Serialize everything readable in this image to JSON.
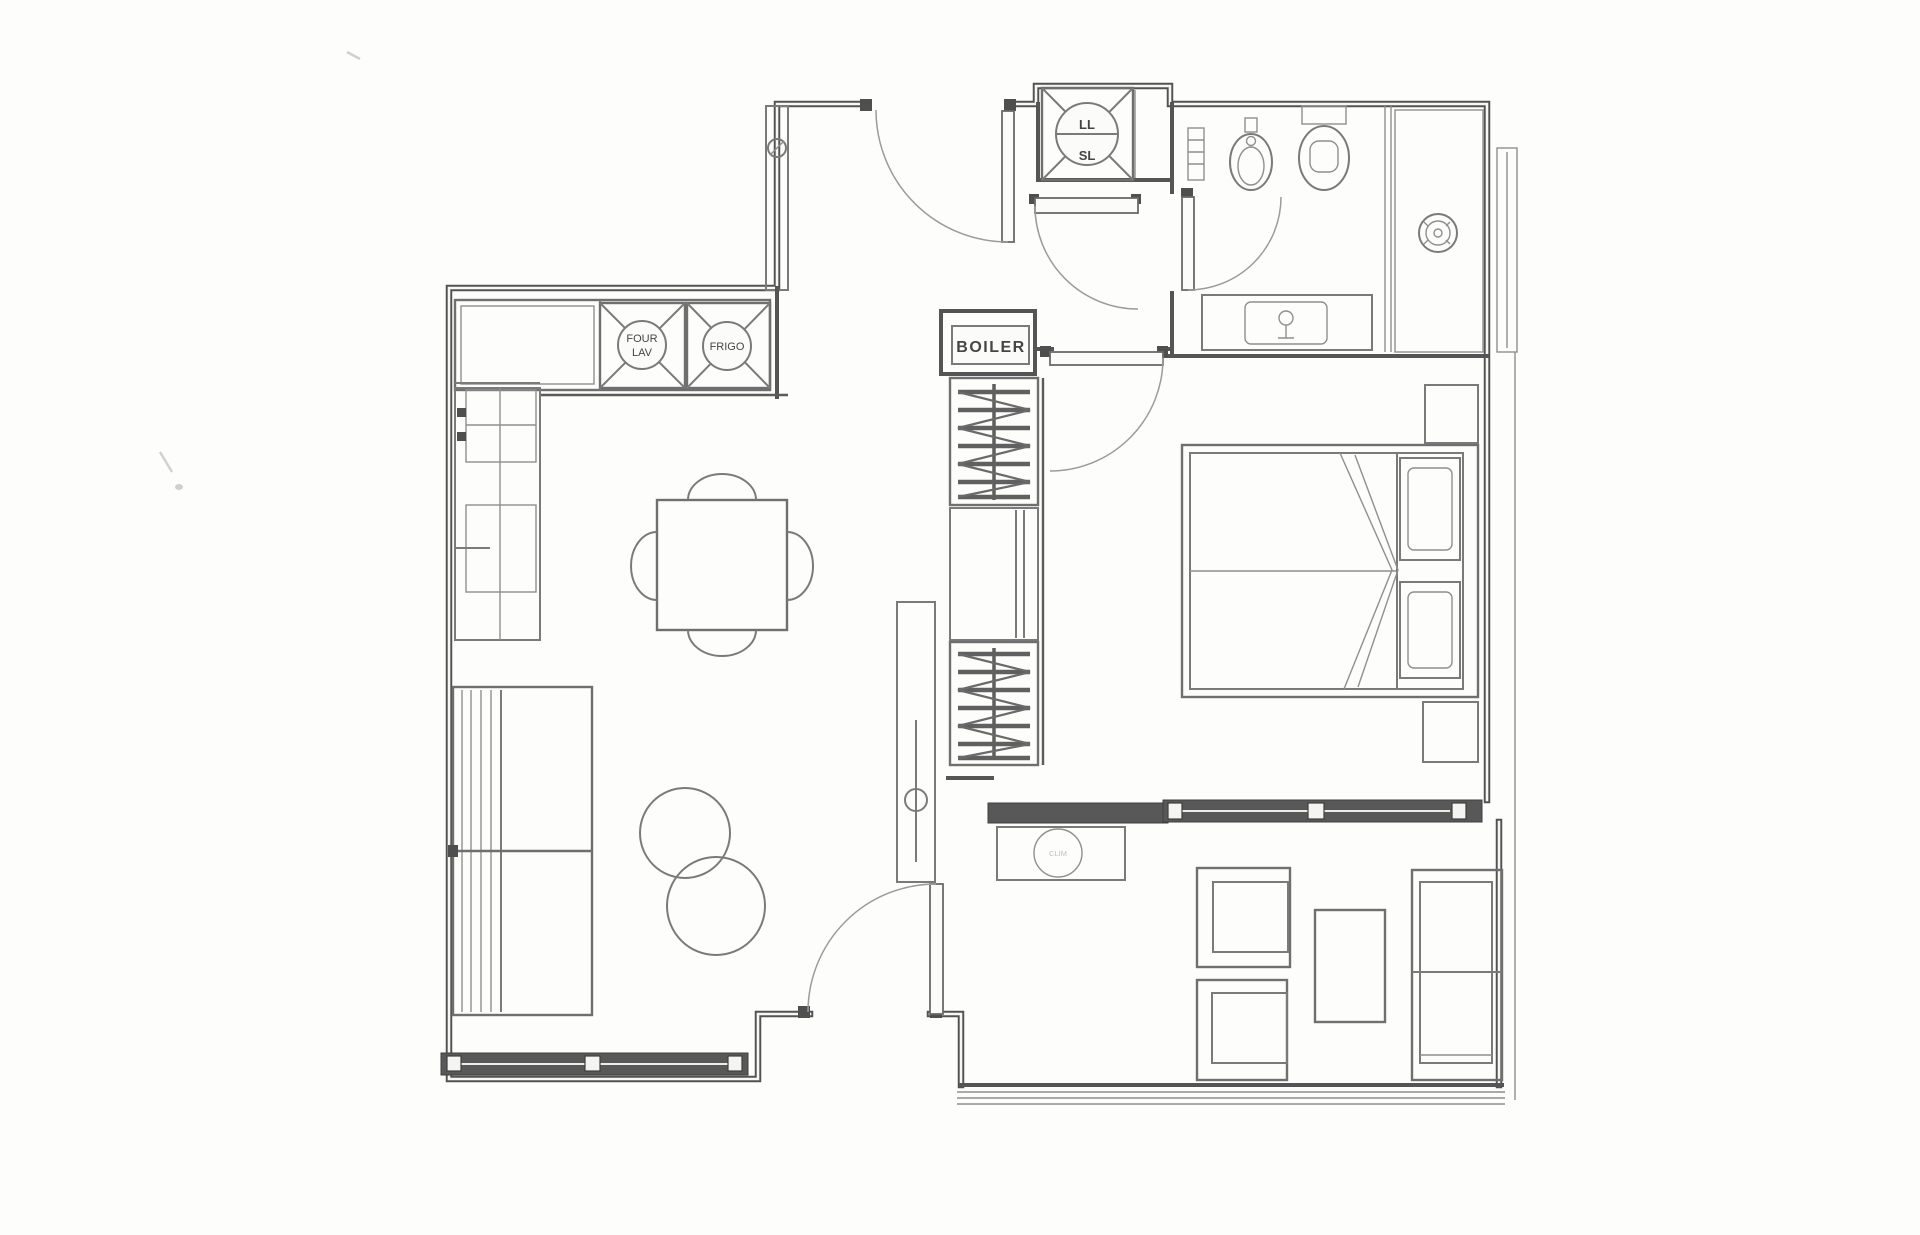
{
  "plan": {
    "kitchen": {
      "oven_dishwasher_label_line1": "FOUR",
      "oven_dishwasher_label_line2": "LAV",
      "fridge_label": "FRIGO"
    },
    "utility": {
      "boiler_label": "BOILER",
      "washer_label": "LL",
      "dryer_label": "SL"
    },
    "hallway": {
      "ac_unit_label": "CLIM"
    },
    "colors": {
      "wall": "#525252",
      "window_band": "#585858",
      "paper": "#fdfdfc",
      "furniture_line": "#7a7a7a"
    }
  }
}
